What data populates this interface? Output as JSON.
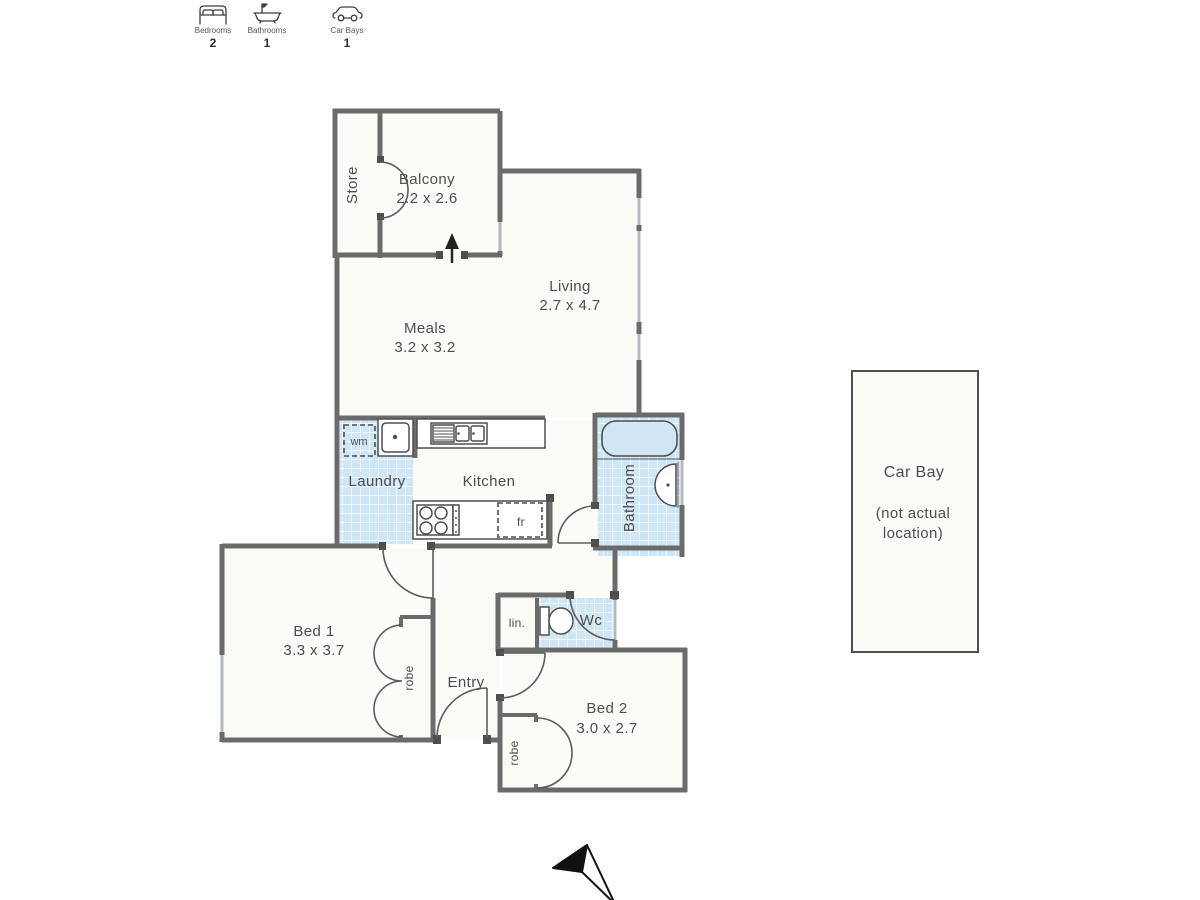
{
  "colors": {
    "background": "#ffffff",
    "wall": "#6b6b6b",
    "window": "#b2b8bc",
    "tile": "#cfe7f5",
    "text": "#4d4d4d",
    "floor": "#fbfbf7"
  },
  "summary": [
    {
      "icon": "bed-icon",
      "label": "Bedrooms",
      "value": "2"
    },
    {
      "icon": "bath-icon",
      "label": "Bathrooms",
      "value": "1"
    },
    {
      "icon": "car-icon",
      "label": "Car Bays",
      "value": "1"
    }
  ],
  "rooms": {
    "store": {
      "label": "Store"
    },
    "balcony": {
      "label": "Balcony",
      "dims": "2.2 x 2.6"
    },
    "living": {
      "label": "Living",
      "dims": "2.7 x 4.7"
    },
    "meals": {
      "label": "Meals",
      "dims": "3.2 x 3.2"
    },
    "laundry": {
      "label": "Laundry"
    },
    "kitchen": {
      "label": "Kitchen"
    },
    "bathroom": {
      "label": "Bathroom"
    },
    "wc": {
      "label": "Wc"
    },
    "linen": {
      "label": "lin."
    },
    "entry": {
      "label": "Entry"
    },
    "bed1": {
      "label": "Bed 1",
      "dims": "3.3 x 3.7"
    },
    "bed2": {
      "label": "Bed 2",
      "dims": "3.0 x 2.7"
    },
    "robe1": {
      "label": "robe"
    },
    "robe2": {
      "label": "robe"
    }
  },
  "fixtures": {
    "washing_machine": "wm",
    "fridge": "fr"
  },
  "car_bay": {
    "title": "Car Bay",
    "note1": "(not actual",
    "note2": "location)"
  }
}
